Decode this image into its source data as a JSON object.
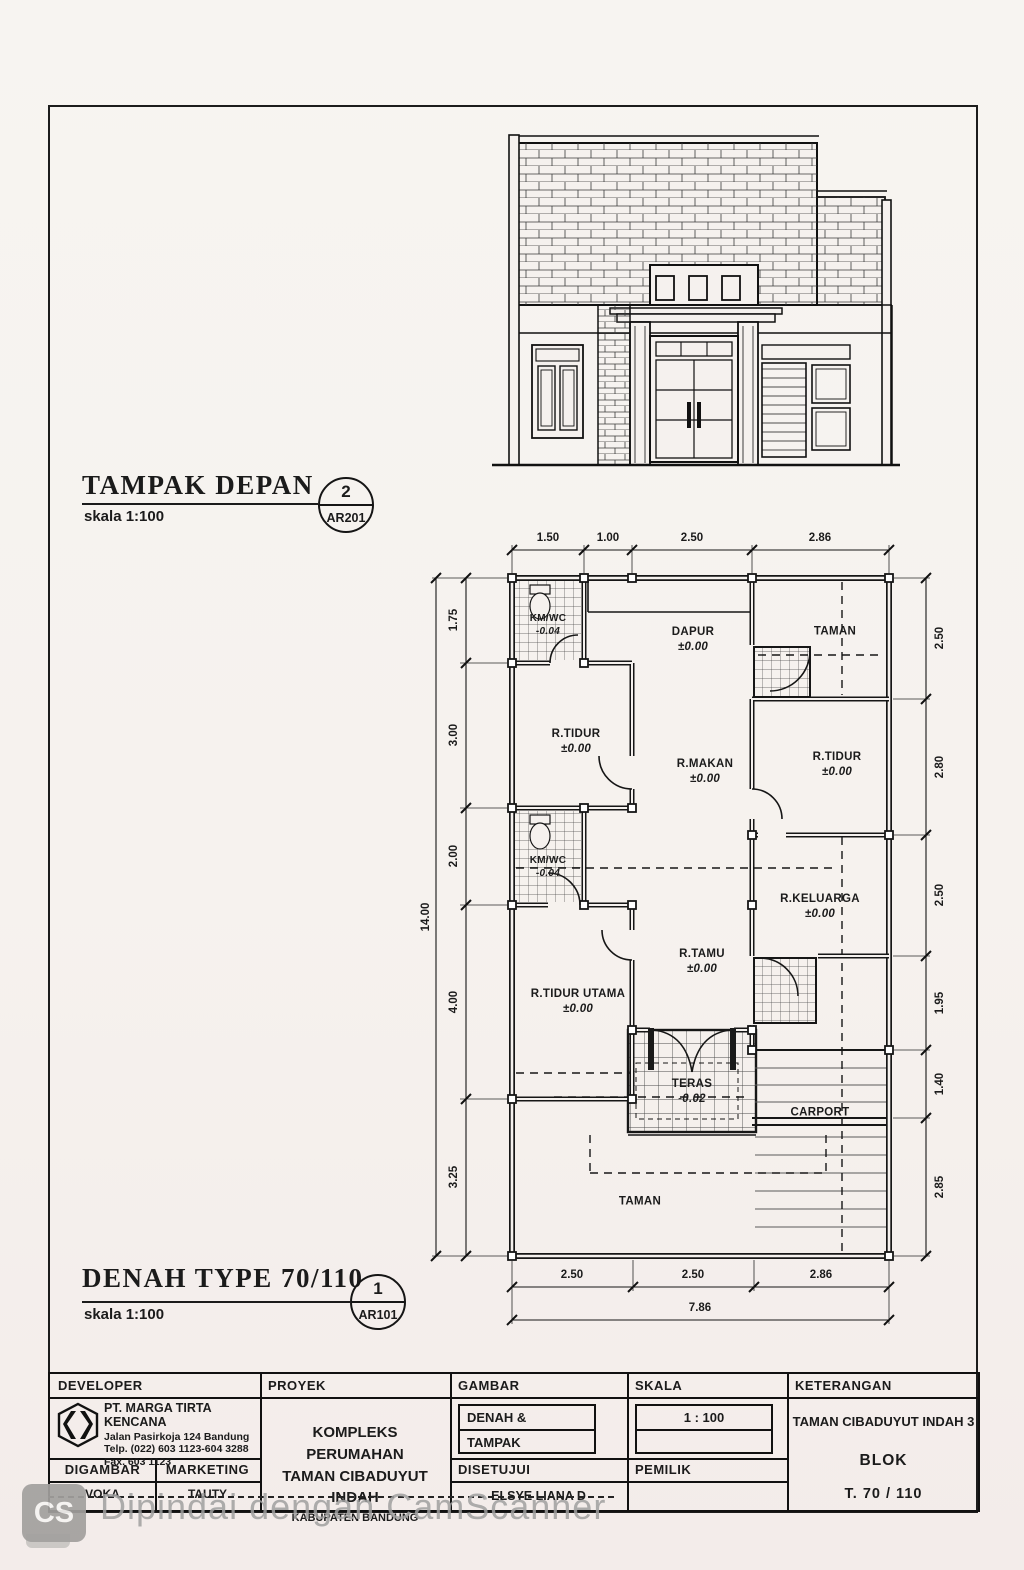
{
  "elevation_title": {
    "title": "TAMPAK DEPAN",
    "scale": "skala 1:100",
    "number": "2",
    "code": "AR201"
  },
  "plan_title": {
    "title": "DENAH TYPE 70/110",
    "scale": "skala 1:100",
    "number": "1",
    "code": "AR101"
  },
  "plan": {
    "rooms": [
      {
        "name": "KM/WC",
        "level": "-0.04"
      },
      {
        "name": "DAPUR",
        "level": "±0.00"
      },
      {
        "name": "TAMAN"
      },
      {
        "name": "R.TIDUR",
        "level": "±0.00"
      },
      {
        "name": "R.MAKAN",
        "level": "±0.00"
      },
      {
        "name": "R.TIDUR",
        "level": "±0.00"
      },
      {
        "name": "KM/WC",
        "level": "-0.04"
      },
      {
        "name": "R.KELUARGA",
        "level": "±0.00"
      },
      {
        "name": "R.TAMU",
        "level": "±0.00"
      },
      {
        "name": "R.TIDUR UTAMA",
        "level": "±0.00"
      },
      {
        "name": "TERAS",
        "level": "-0.02"
      },
      {
        "name": "CARPORT"
      },
      {
        "name": "TAMAN"
      }
    ],
    "dims": {
      "top": [
        "1.50",
        "1.00",
        "2.50",
        "2.86"
      ],
      "left": [
        "1.75",
        "3.00",
        "2.00",
        "4.00",
        "3.25"
      ],
      "left_total": "14.00",
      "right": [
        "2.50",
        "2.80",
        "2.50",
        "1.95",
        "1.40",
        "2.85"
      ],
      "bottom": [
        "2.50",
        "2.50",
        "2.86"
      ],
      "bottom_total": "7.86"
    }
  },
  "titleblock": {
    "developer": {
      "label": "DEVELOPER",
      "company": "PT. MARGA TIRTA KENCANA",
      "address": "Jalan Pasirkoja 124 Bandung",
      "phone": "Telp. (022) 603 1123-604 3288",
      "fax": "Fax. 603 1123"
    },
    "digambar": {
      "label": "DIGAMBAR",
      "value": "VOKA"
    },
    "marketing": {
      "label": "MARKETING",
      "value": "TAUTY"
    },
    "proyek": {
      "label": "PROYEK",
      "line1": "KOMPLEKS PERUMAHAN",
      "line2": "TAMAN CIBADUYUT INDAH",
      "line3": "KABUPATEN BANDUNG"
    },
    "gambar": {
      "label": "GAMBAR",
      "line1": "DENAH &",
      "line2": "TAMPAK"
    },
    "skala": {
      "label": "SKALA",
      "value": "1 : 100"
    },
    "disetujui": {
      "label": "DISETUJUI",
      "value": "ELSYE LIANA D"
    },
    "pemilik": {
      "label": "PEMILIK",
      "value": ""
    },
    "keterangan": {
      "label": "KETERANGAN",
      "line1": "TAMAN CIBADUYUT INDAH 3",
      "line2": "BLOK",
      "line3": "T. 70 / 110"
    }
  },
  "watermark": {
    "badge": "CS",
    "text": "Dipindai dengan CamScanner"
  }
}
